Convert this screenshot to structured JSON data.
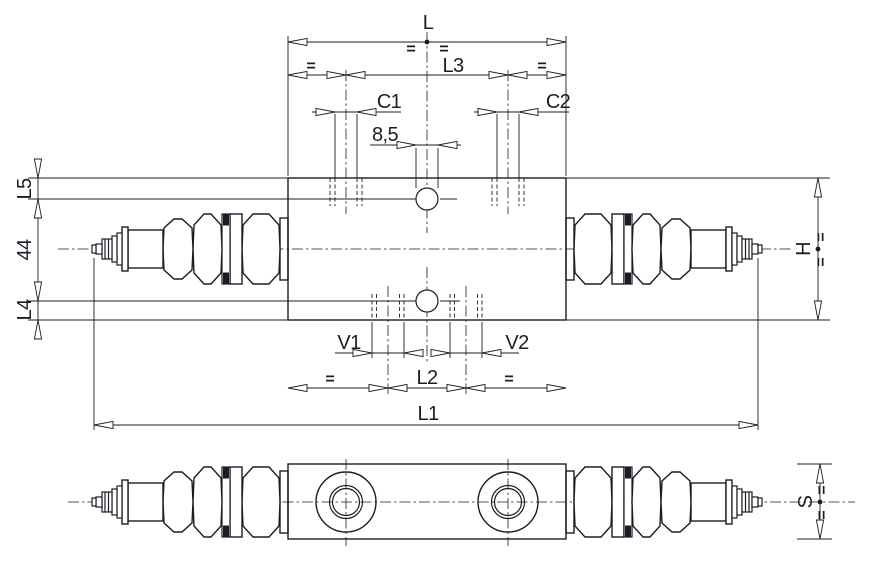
{
  "drawing": {
    "description": "Two-view dimensioned technical drawing of an in-line dual cartridge valve block (top view and side view)",
    "views": {
      "top": "top-view",
      "side": "side-view"
    }
  },
  "colors": {
    "line": "#1c1c24",
    "background": "#ffffff"
  },
  "labels": {
    "overall_body_width": "L",
    "port_spacing_top": "L3",
    "port_c1": "C1",
    "port_c2": "C2",
    "hole_diameter": "8,5",
    "edge_to_hole_top": "L5",
    "hole_spacing": "44",
    "edge_to_hole_bottom": "L4",
    "port_v1": "V1",
    "port_v2": "V2",
    "port_spacing_bottom": "L2",
    "overall_length": "L1",
    "body_height": "H",
    "body_thickness": "S",
    "equals": "="
  }
}
